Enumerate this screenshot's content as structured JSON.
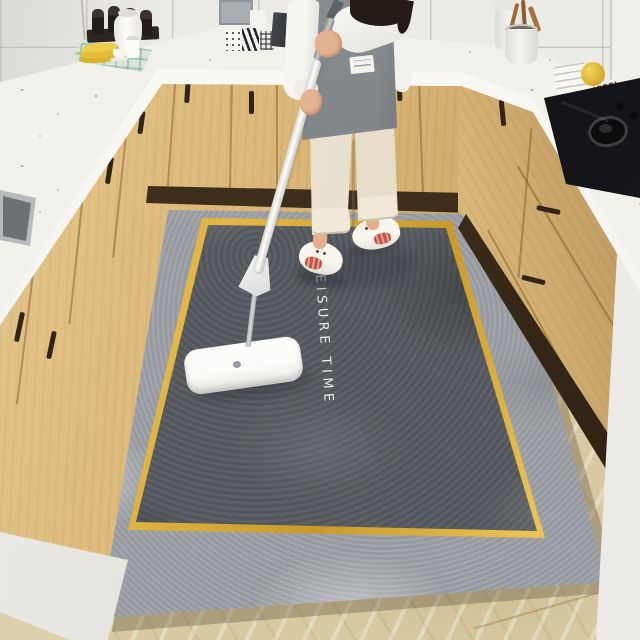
{
  "scene": {
    "setting": "U-shaped kitchen with light wood cabinets, white marble counters and tiled walls",
    "subject": "Person in a grey apron and slippers cleaning a large grey kitchen mat with a white flat mop",
    "rug": {
      "text": "LEISURE TIME",
      "text_color": "#f5f6f7",
      "field_color": "#565a5f",
      "border_color": "#9da1a6",
      "trim_color": "#d2a437"
    },
    "palette": {
      "cabinets": "#d9b676",
      "countertop": "#f2f0ea",
      "wall_tiles": "#eceae5",
      "floor": "#d8c9a3",
      "stove": "#17181b",
      "apron": "#7c8286",
      "pants": "#eae2d0",
      "mop": "#f5f4f1",
      "slippers": "#f6f2eb",
      "accent_yellow": "#e3bf38"
    },
    "objects": [
      "person-mopping",
      "flat-mop",
      "kitchen-rug",
      "kitchen-sink",
      "gas-cooktop",
      "dish-rack",
      "utensil-crock",
      "storage-jar",
      "patterned-mugs",
      "spice-grinders",
      "water-jug",
      "milk-bottle",
      "yellow-plate-stack",
      "teacup",
      "plaid-placemat",
      "knife-block",
      "cabinet-handles"
    ]
  }
}
